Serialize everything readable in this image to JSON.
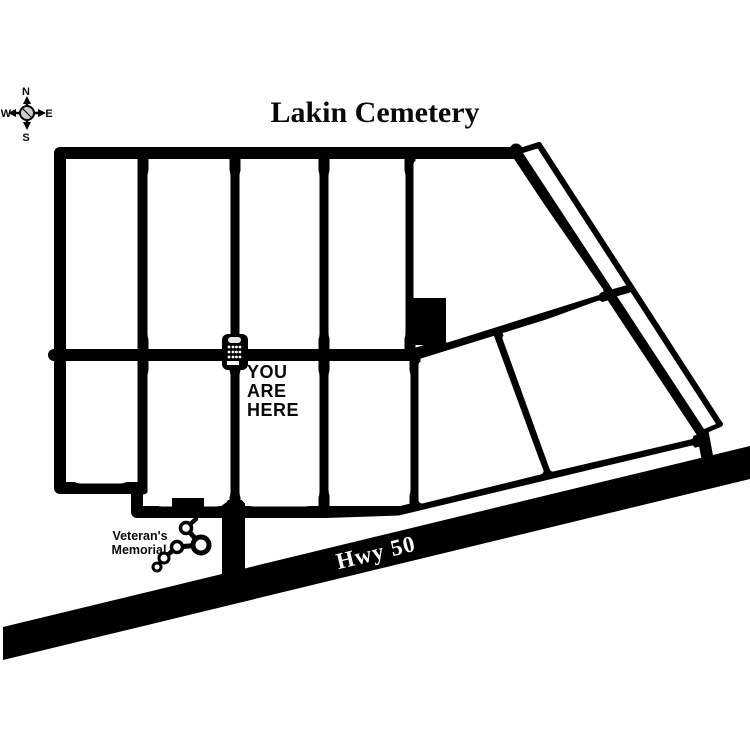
{
  "title": "Lakin Cemetery",
  "compass": {
    "n": "N",
    "s": "S",
    "e": "E",
    "w": "W"
  },
  "map": {
    "you_are_here": {
      "line1": "YOU",
      "line2": "ARE",
      "line3": "HERE"
    },
    "veterans_memorial": {
      "line1": "Veteran's",
      "line2": "Memorial"
    },
    "highway": {
      "label": "Hwy 50"
    }
  },
  "icons": {
    "compass_rose": "four-point compass with N/S/E/W arrows and center circle",
    "kiosk": "information-kiosk pictograph marking current location",
    "memorial": "cluster of linked rings sculpture"
  },
  "colors": {
    "road": "#000000",
    "background": "#ffffff",
    "highway_label_text": "#ffffff",
    "kiosk_detail": "#ffffff"
  }
}
